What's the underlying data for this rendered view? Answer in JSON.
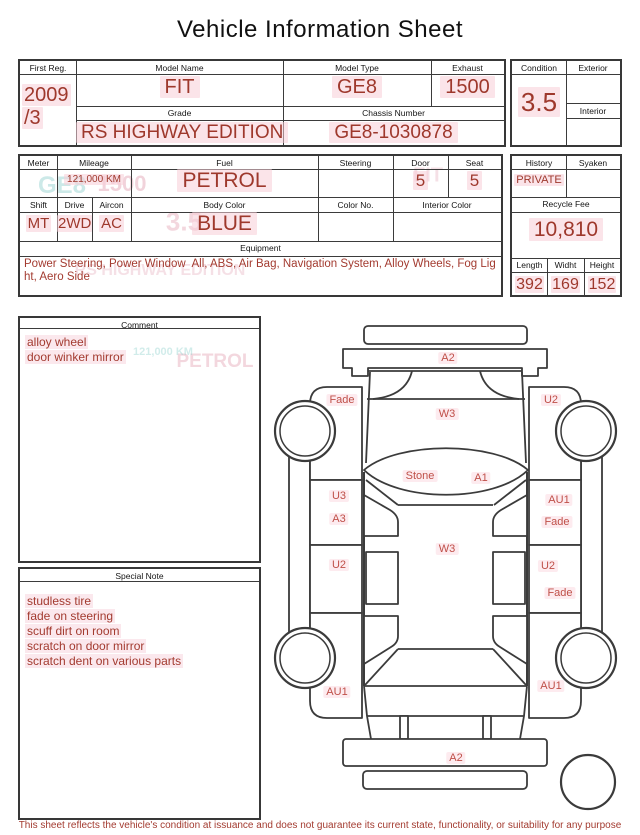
{
  "title": "Vehicle Information Sheet",
  "vehicle": {
    "first_reg_label": "First Reg.",
    "first_reg_line1": "2009",
    "first_reg_line2": "/3",
    "model_name_label": "Model Name",
    "model_name": "FIT",
    "model_type_label": "Model Type",
    "model_type": "GE8",
    "exhaust_label": "Exhaust",
    "exhaust": "1500",
    "grade_label": "Grade",
    "grade": "RS HIGHWAY EDITION",
    "chassis_label": "Chassis Number",
    "chassis_number": "GE8-1030878"
  },
  "condition": {
    "label": "Condition",
    "value": "3.5",
    "exterior_label": "Exterior",
    "interior_label": "Interior"
  },
  "specs": {
    "meter_label": "Meter",
    "meter": "",
    "mileage_label": "Mileage",
    "mileage": "121,000 KM",
    "fuel_label": "Fuel",
    "fuel": "PETROL",
    "steering_label": "Steering",
    "steering": "",
    "door_label": "Door",
    "door": "5",
    "seat_label": "Seat",
    "seat": "5",
    "shift_label": "Shift",
    "shift": "MT",
    "drive_label": "Drive",
    "drive": "2WD",
    "aircon_label": "Aircon",
    "aircon": "AC",
    "body_color_label": "Body Color",
    "body_color": "BLUE",
    "color_no_label": "Color No.",
    "color_no": "",
    "interior_color_label": "Interior Color",
    "interior_color": ""
  },
  "equipment": {
    "label": "Equipment",
    "value": "Power Steering, Power Window  All, ABS, Air Bag, Navigation System, Alloy Wheels, Fog Light, Aero Side"
  },
  "history_box": {
    "history_label": "History",
    "history": "PRIVATE",
    "syaken_label": "Syaken",
    "syaken": "",
    "recycle_fee_label": "Recycle Fee",
    "recycle_fee": "10,810"
  },
  "dimensions": {
    "length_label": "Length",
    "length": "392",
    "width_label": "Widht",
    "width": "169",
    "height_label": "Height",
    "height": "152"
  },
  "comment": {
    "label": "Comment",
    "items": [
      "alloy wheel",
      "door winker mirror"
    ]
  },
  "special_note": {
    "label": "Special Note",
    "items": [
      "studless tire",
      "fade on steering",
      "scuff dirt on room",
      "scratch on door mirror",
      "scratch dent on various parts"
    ]
  },
  "diagram": {
    "front_bumper": "A2",
    "windshield": "W3",
    "roof_stone": "Stone",
    "roof_a1": "A1",
    "roof_center": "W3",
    "rear_bumper": "A2",
    "left_front_fender": "Fade",
    "left_front_door_1": "U3",
    "left_front_door_2": "A3",
    "left_rear_door": "U2",
    "left_rear_fender": "AU1",
    "right_front_fender": "U2",
    "right_front_door_1": "AU1",
    "right_front_door_2": "Fade",
    "right_rear_door_1": "U2",
    "right_rear_door_2": "Fade",
    "right_rear_fender": "AU1"
  },
  "ghosts": {
    "g1": "GE8",
    "g2": "1500",
    "g3": "FIT",
    "g4": "3.5",
    "g5": "RS HIGHWAY EDITION",
    "g6": "PETROL",
    "g7": "121,000 KM"
  },
  "disclaimer": "This sheet reflects the vehicle's condition at issuance and does not guarantee its current state, functionality, or suitability for any purpose",
  "colors": {
    "accent_red": "#A33B30",
    "value_red": "#9E382C",
    "diagram_label_red": "#BF4F48",
    "highlight_pink": "#F7CDD7",
    "line": "#3B3B3B"
  }
}
